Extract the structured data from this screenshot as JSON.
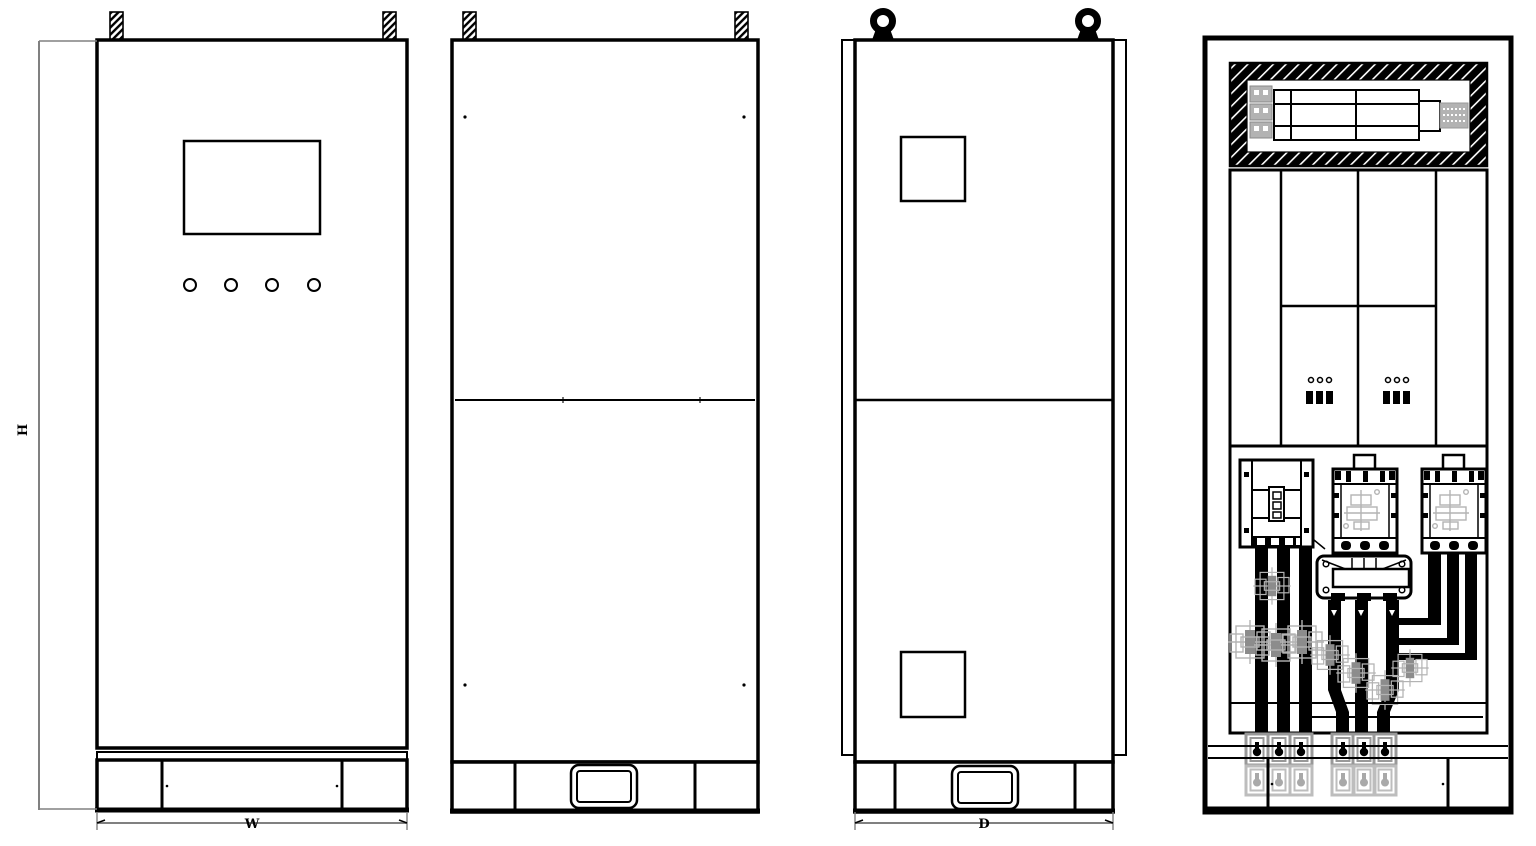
{
  "drawing": {
    "dimension_labels": {
      "height": "H",
      "width": "W",
      "depth": "D"
    }
  },
  "colors": {
    "line": "#000000",
    "background": "#ffffff",
    "dimension_line": "#808080",
    "component_overlay_gray": "#b3b3b3",
    "terminal_gray": "#999999",
    "terminal_light_gray": "#bdbdbd"
  }
}
